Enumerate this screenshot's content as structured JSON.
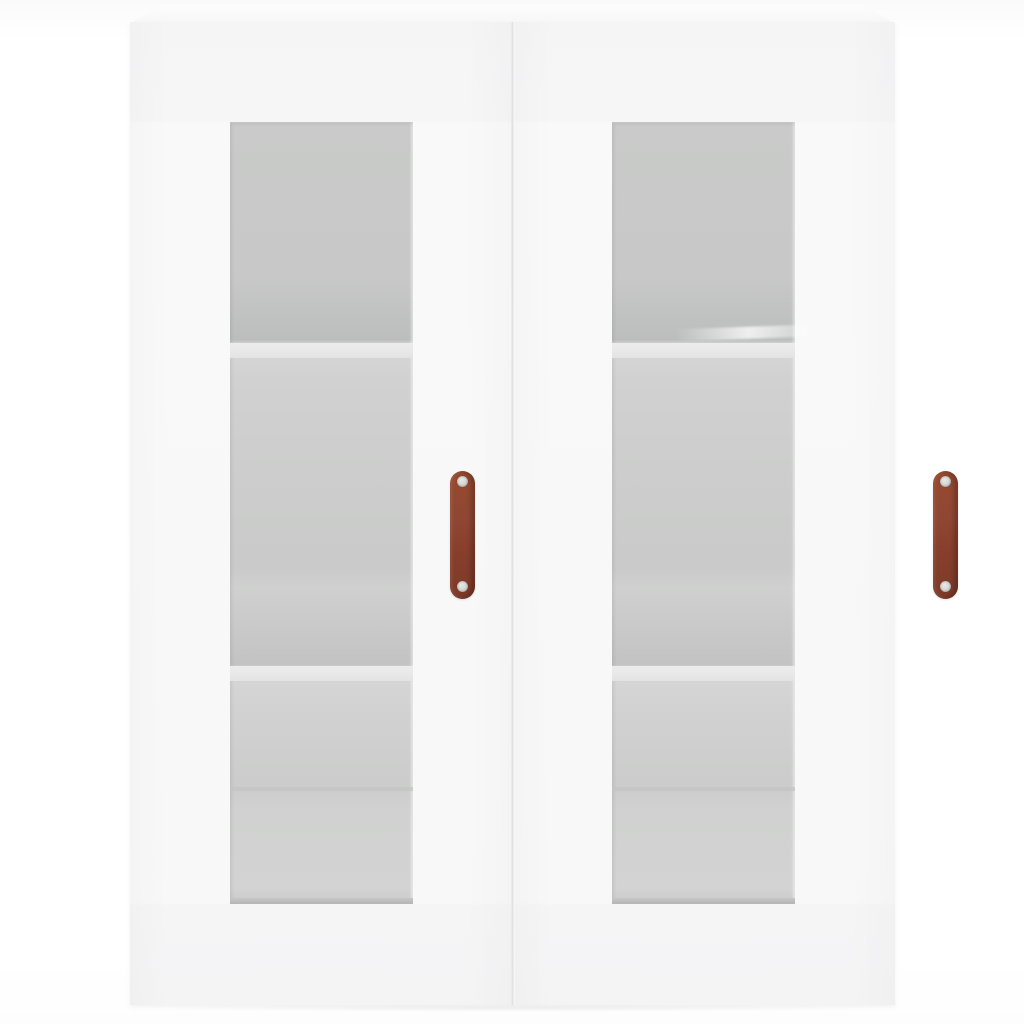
{
  "meta": {
    "description": "Product photograph of a white wall-mounted display cabinet with two glass-paneled doors, visible interior shelves and brown leather-strap handles, on a plain white background",
    "visible_text": ""
  },
  "object": {
    "type": "wall-cabinet",
    "finish": "white",
    "doors": [
      {
        "id": "left",
        "glass_panel": true,
        "handle": "brown-strap-handle",
        "handle_screws": 2
      },
      {
        "id": "right",
        "glass_panel": true,
        "handle": "brown-strap-handle",
        "handle_screws": 2
      }
    ],
    "shelf_lines_visible_per_door": 3
  },
  "colors": {
    "background": "#ffffff",
    "cabinet_face": "#f7f7f8",
    "cabinet_edge_shadow": "#e7e7e8",
    "door_gap": "#dfdfe0",
    "glass_top": "#c9cac9",
    "glass_shelf_shadow": "#bcbdbd",
    "shelf_edge": "#e9eae9",
    "glass_bottom_line": "#b4b5b4",
    "handle_top": "#96492e",
    "handle_bottom": "#7c3a28",
    "screw": "#d9d9d6"
  }
}
